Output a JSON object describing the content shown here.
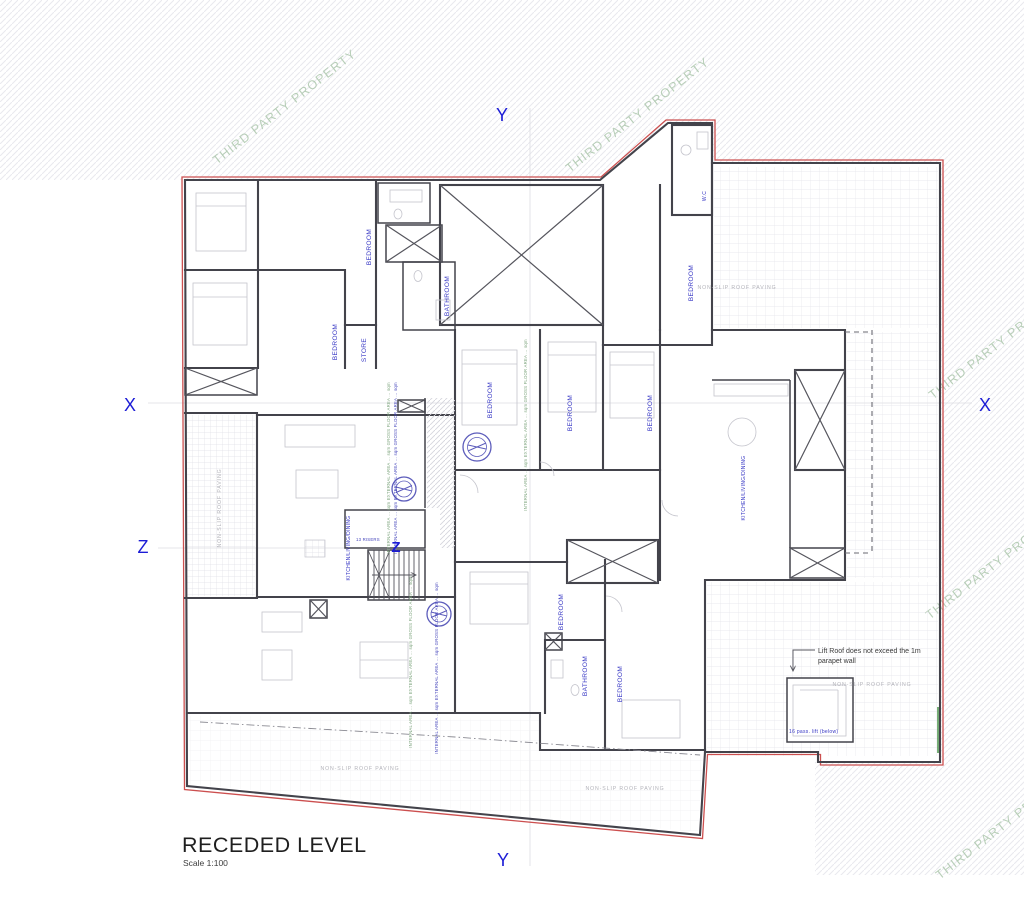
{
  "drawing": {
    "title": "RECEDED LEVEL",
    "scale": "Scale 1:100"
  },
  "watermark": {
    "text": "THIRD PARTY PROPERTY"
  },
  "markers": {
    "x": "X",
    "y": "Y",
    "z": "Z"
  },
  "rooms": [
    {
      "label": "BEDROOM"
    },
    {
      "label": "BEDROOM"
    },
    {
      "label": "STORE"
    },
    {
      "label": "BATHROOM"
    },
    {
      "label": "W.C"
    },
    {
      "label": "BEDROOM"
    },
    {
      "label": "BEDROOM"
    },
    {
      "label": "BEDROOM"
    },
    {
      "label": "BEDROOM"
    },
    {
      "label": "KITCHEN/LIVING/DINING"
    },
    {
      "label": "KITCHEN/LIVING/DINING"
    },
    {
      "label": "BEDROOM"
    },
    {
      "label": "BATHROOM"
    },
    {
      "label": "BEDROOM"
    }
  ],
  "stairs": {
    "note": "13 RISERS"
  },
  "notes": {
    "lift_roof_line1": "Lift Roof does not exceed the 1m",
    "lift_roof_line2": "parapet wall",
    "lift_below": "16 pass. lift (below)",
    "area_note": "INTERNAL AREA … sqm  EXTERNAL AREA … sqm  GROSS FLOOR AREA … sqm"
  },
  "paving_label": "NON-SLIP ROOF PAVING",
  "colors": {
    "boundary_red": "#cc4f4f",
    "wall_gray": "#43434b",
    "room_label_blue": "#3636c4",
    "section_marker_blue": "#1c1cd6",
    "watermark_green": "#a8c4a8",
    "stamp_blue": "#4040b0",
    "paving_gray": "#b3b3ba"
  }
}
